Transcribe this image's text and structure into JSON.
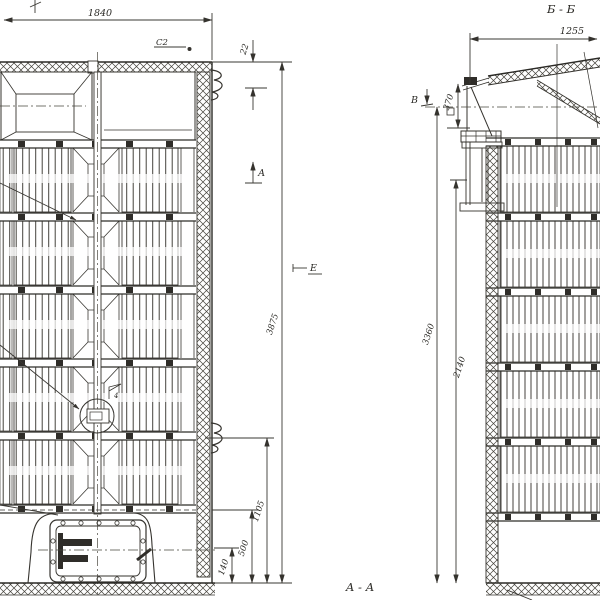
{
  "colors": {
    "paper": "#ffffff",
    "ink": "#35332e"
  },
  "front_view": {
    "dim_width_top": "1840",
    "dim_roof_offset": "22",
    "weld_mark": "С2",
    "section_arrow_label": "А",
    "view_marker_label": "Е",
    "dim_total_height": "3875",
    "dim_door_level": "1105",
    "dim_plinth_level": "500",
    "dim_axis_level": "140",
    "detail_flag_label": "4"
  },
  "section_bb": {
    "title": "Б - Б",
    "dim_width_top": "1255",
    "dim_inlet_height": "370",
    "view_arrow_label": "В",
    "dim_axis_height": "3360",
    "dim_flange_height": "2140"
  },
  "section_aa": {
    "title": "А - А"
  }
}
